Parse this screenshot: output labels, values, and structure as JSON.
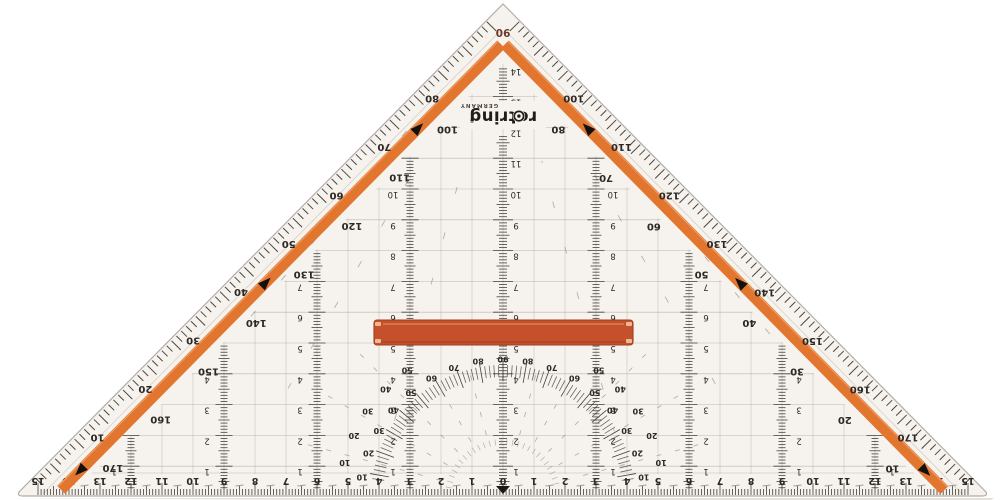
{
  "product": {
    "brand": "rotring",
    "brand_mark": "®",
    "origin_label": "GERMANY",
    "apex_label": "90"
  },
  "colors": {
    "body": "#f6f3ee",
    "edge": "#b3aca5",
    "bevel": "#dcd5ce",
    "shadow": "#ddd8d2",
    "ink": "#2e2825",
    "faint": "#8d837d",
    "grid": "#8d837d",
    "stripe": "#e2762f",
    "apex_label_color": "#6b3a28",
    "handle": "#c4512c",
    "handle_dark": "#a03e20",
    "handle_highlight": "#e08a5f",
    "handle_cap": "#f2bd98"
  },
  "hypotenuse_left": {
    "outer_degrees": [
      "80",
      "70",
      "60",
      "50",
      "40",
      "30",
      "20",
      "10"
    ],
    "inner_degrees": [
      "100",
      "110",
      "120",
      "130",
      "140",
      "150",
      "160",
      "170"
    ]
  },
  "hypotenuse_right": {
    "outer_degrees": [
      "100",
      "110",
      "120",
      "130",
      "140",
      "150",
      "160",
      "170"
    ],
    "inner_degrees": [
      "80",
      "70",
      "60",
      "50",
      "40",
      "30",
      "20",
      "10"
    ]
  },
  "bottom_ruler_cm": [
    "15",
    "14",
    "13",
    "12",
    "11",
    "10",
    "9",
    "8",
    "7",
    "6",
    "5",
    "4",
    "3",
    "2",
    "1",
    "0",
    "1",
    "2",
    "3",
    "4",
    "5",
    "6",
    "7",
    "8",
    "9",
    "10",
    "11",
    "12",
    "13",
    "14",
    "15"
  ],
  "vertical_scales": {
    "center_cm": [
      "1",
      "2",
      "3",
      "4",
      "5",
      "6",
      "7",
      "8",
      "9",
      "10",
      "11",
      "12",
      "13",
      "14"
    ],
    "offset_3cm": [
      "1",
      "2",
      "3",
      "4",
      "5",
      "6",
      "7",
      "8",
      "9",
      "10"
    ],
    "offset_6cm": [
      "1",
      "2",
      "3",
      "4",
      "5",
      "6",
      "7"
    ],
    "offset_9cm": [
      "1",
      "2",
      "3",
      "4"
    ],
    "offset_12cm": [
      "1"
    ]
  },
  "protractor": {
    "ring_degrees": [
      "10",
      "20",
      "30",
      "40",
      "50",
      "60",
      "70",
      "80",
      "90",
      "80",
      "70",
      "60",
      "50",
      "40",
      "30",
      "20",
      "10"
    ],
    "outer_ring_degrees": [
      "10",
      "20",
      "30",
      "40",
      "50"
    ]
  }
}
